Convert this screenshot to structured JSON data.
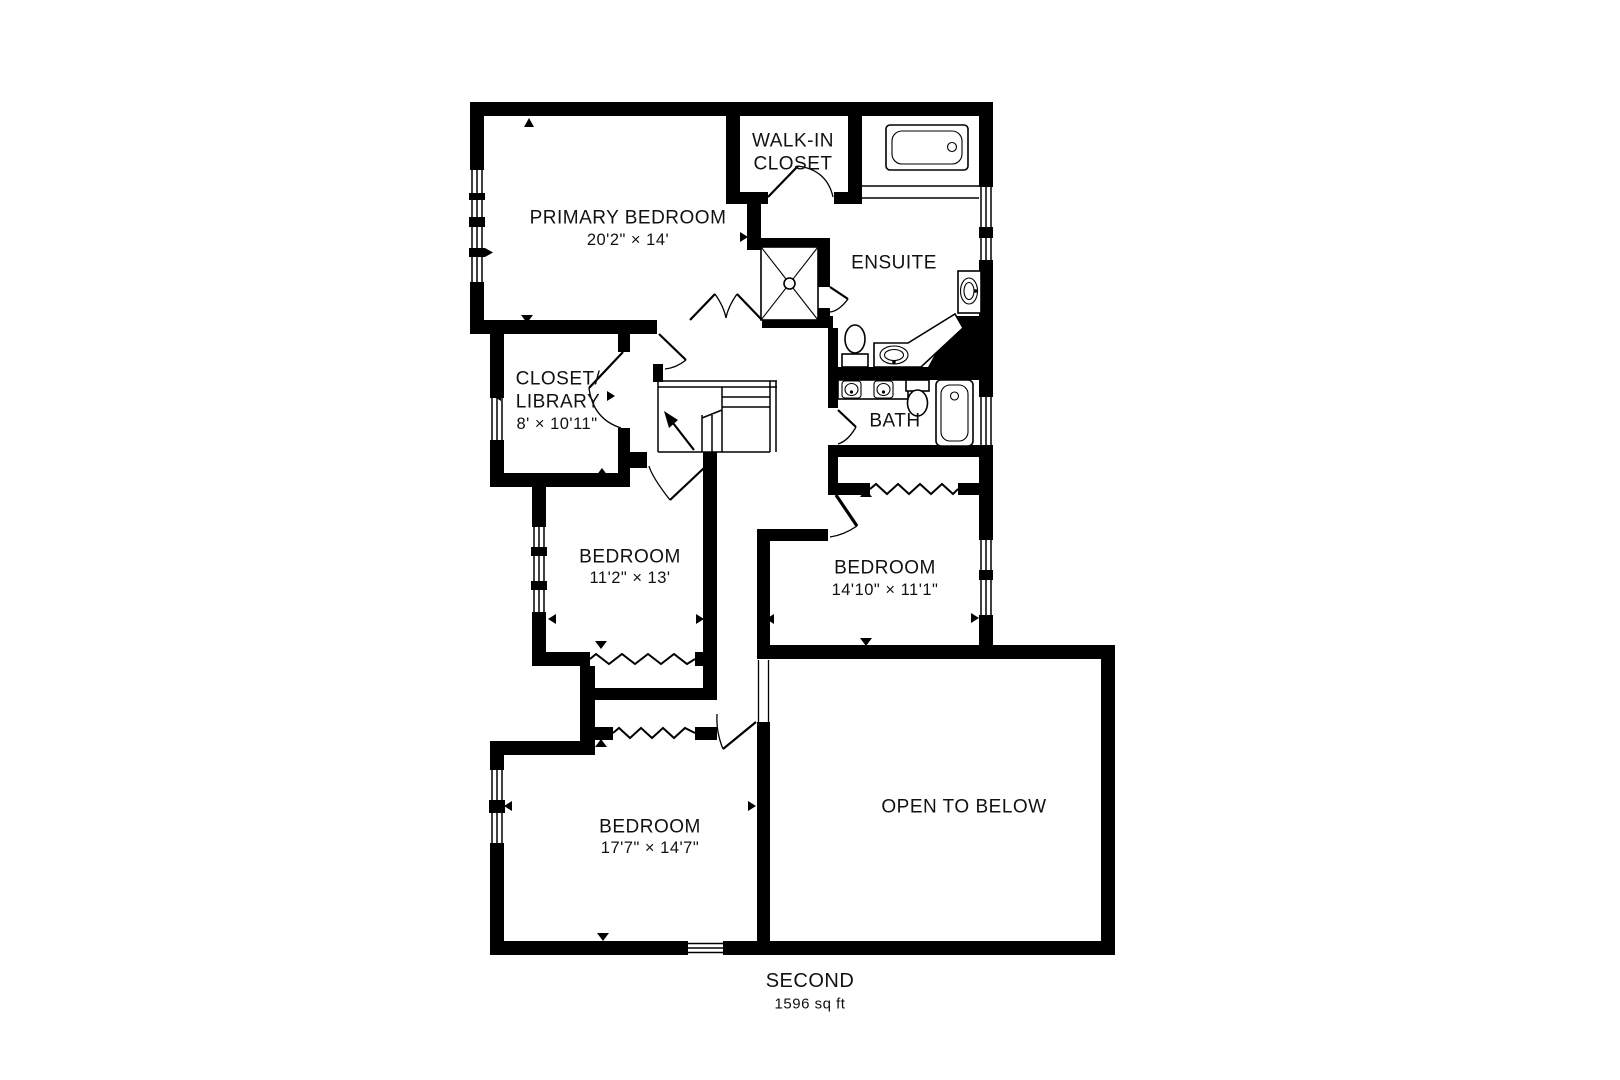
{
  "plan": {
    "type": "floor-plan",
    "rooms": {
      "primary_bedroom": {
        "name": "PRIMARY BEDROOM",
        "dims": "20'2\" × 14'"
      },
      "walk_in_closet": {
        "line1": "WALK-IN",
        "line2": "CLOSET"
      },
      "ensuite": {
        "name": "ENSUITE"
      },
      "closet_library": {
        "line1": "CLOSET/",
        "line2": "LIBRARY",
        "dims": "8' × 10'11\""
      },
      "bath": {
        "name": "BATH"
      },
      "bedroom_1": {
        "name": "BEDROOM",
        "dims": "11'2\" × 13'"
      },
      "bedroom_2": {
        "name": "BEDROOM",
        "dims": "14'10\" × 11'1\""
      },
      "bedroom_3": {
        "name": "BEDROOM",
        "dims": "17'7\" × 14'7\""
      },
      "open_to_below": {
        "name": "OPEN TO BELOW"
      }
    },
    "footer": {
      "floor_name": "SECOND",
      "area": "1596 sq ft"
    },
    "fixtures": [
      "bathtub-ensuite",
      "shower-stall",
      "toilet-ensuite",
      "vanity-sink-ensuite",
      "pedestal-sink-ensuite",
      "double-vanity-bath",
      "toilet-bath",
      "bathtub-bath",
      "staircase-up",
      "closet-rod-lines",
      "window-symbols",
      "door-swings"
    ],
    "colors": {
      "walls": "#000000",
      "background": "#ffffff",
      "text": "#111111"
    }
  }
}
